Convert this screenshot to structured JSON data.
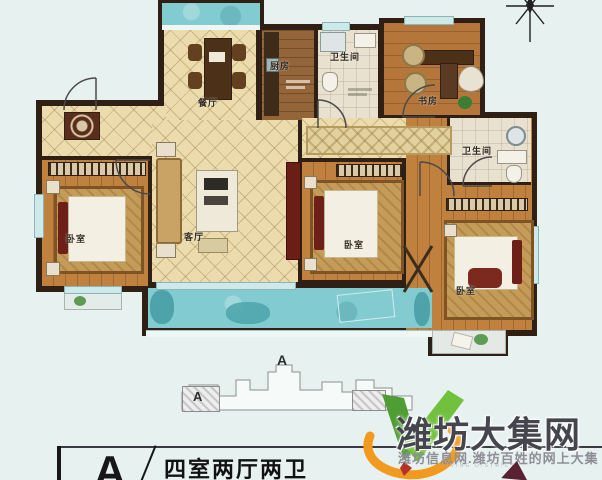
{
  "floorplan": {
    "rooms": {
      "dining": "餐厅",
      "kitchen": "厨房",
      "bath_top": "卫生间",
      "study": "书房",
      "bedroom_left": "卧室",
      "living": "客厅",
      "bedroom_mid": "卧室",
      "bath_right": "卫生间",
      "bedroom_br": "卧室"
    }
  },
  "keyplan": {
    "unit_label": "A",
    "tower_label": "A"
  },
  "infobox": {
    "unit_letter": "A",
    "layout_text": "四室两厅两卫"
  },
  "watermark": {
    "title": "潍坊大集网",
    "subtitle": "潍坊信息网.潍坊百姓的网上大集",
    "tagline": "LIVING DISTRICT"
  },
  "colors": {
    "background": "#e7f2f0",
    "wall": "#2f1f15",
    "tile_cream": "#ecdbac",
    "wood": "#c0813f",
    "balcony_teal": "#82cbd1",
    "accent_maroon": "#6b1e15",
    "brand_green": "#5aab3a",
    "brand_orange": "#f19a1e",
    "brand_text_gray": "#45454e"
  }
}
